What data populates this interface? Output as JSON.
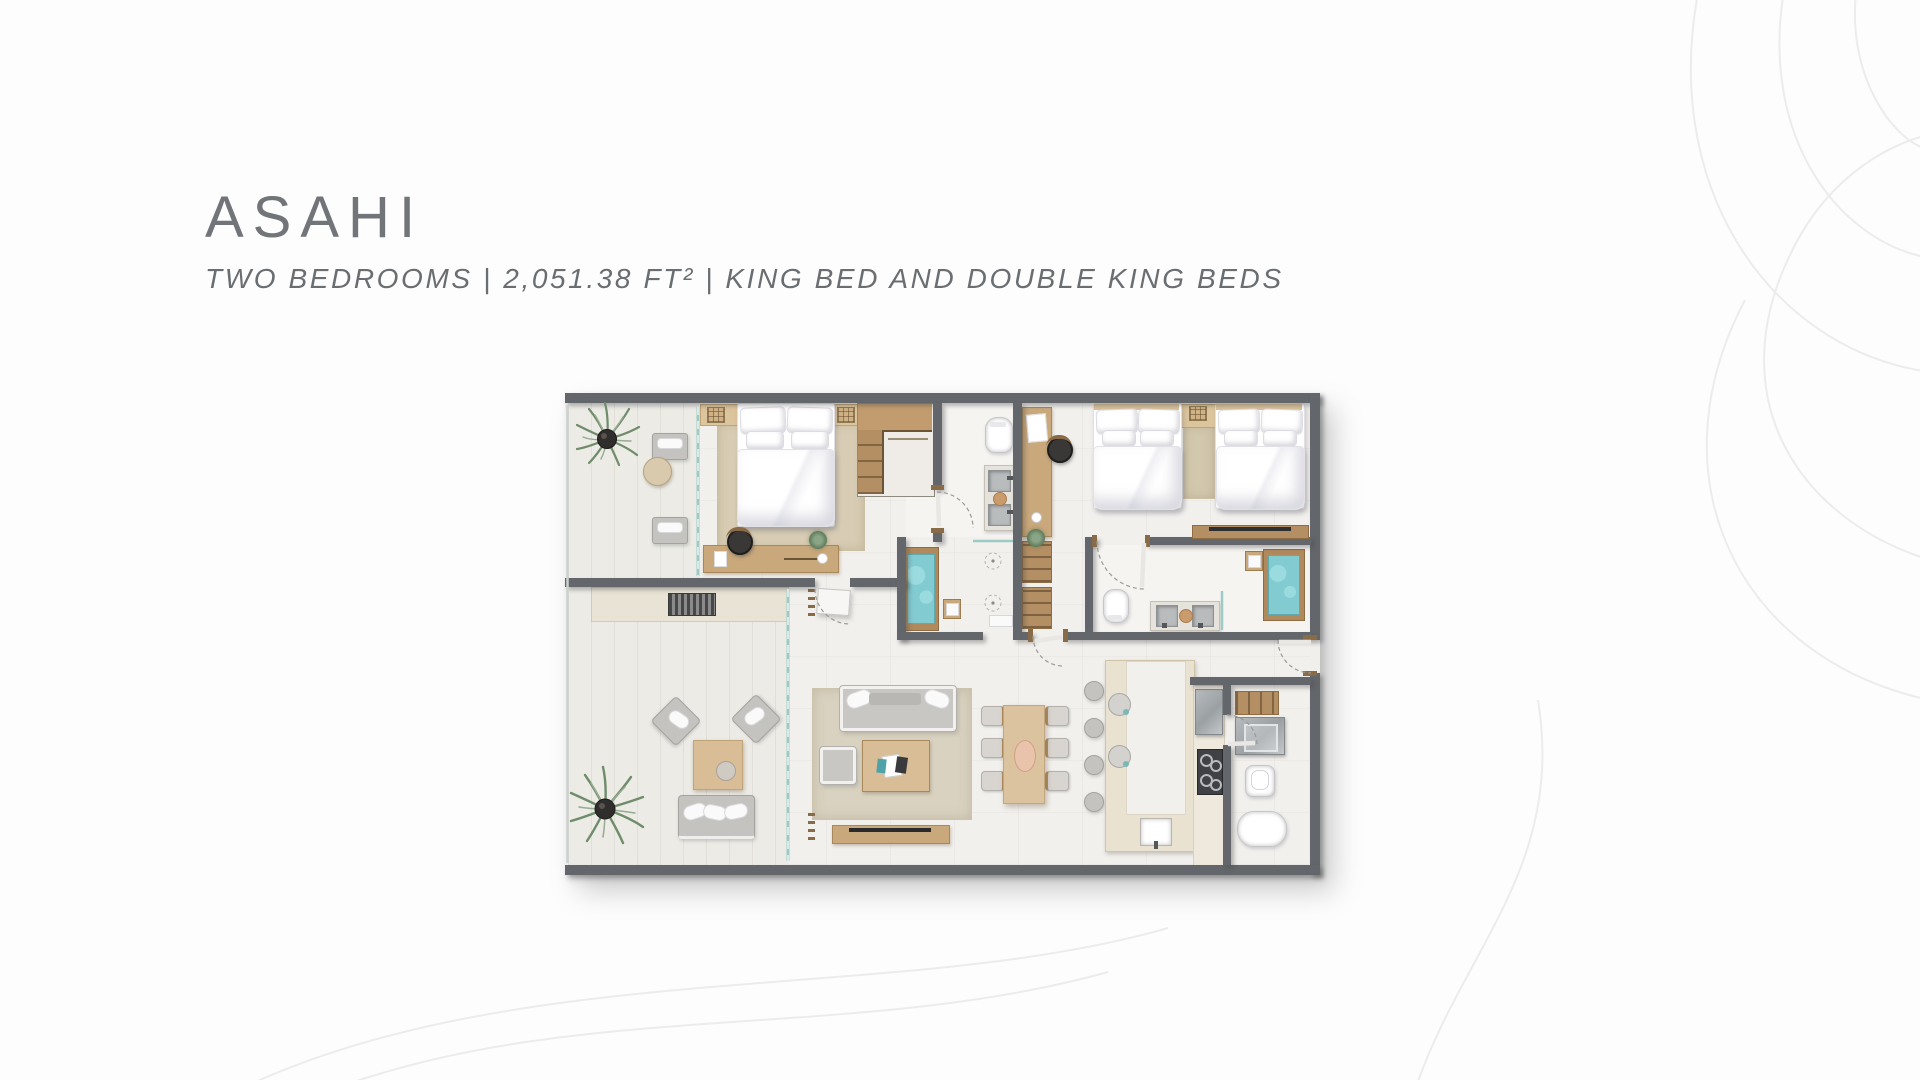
{
  "page": {
    "background": "#fdfdfd"
  },
  "header": {
    "title": "ASAHI",
    "subtitle": "TWO BEDROOMS | 2,051.38 FT² | KING BED AND DOUBLE KING BEDS"
  },
  "floorplan": {
    "view": "top-down architectural rendering, no text labels",
    "rooms": {
      "terrace": [
        "palm-plant",
        "lounge-chair",
        "lounge-chair",
        "round-side-table",
        "outdoor-armchair",
        "outdoor-armchair",
        "outdoor-coffee-table",
        "outdoor-sofa",
        "palm-plant",
        "built-in-bench",
        "ac-vent-grille"
      ],
      "primary_bedroom": [
        "king-bed",
        "nightstand",
        "nightstand",
        "table-lamp",
        "table-lamp",
        "area-rug",
        "built-in-wardrobe",
        "desk",
        "desk-chair",
        "desk-plant",
        "coffee-cup"
      ],
      "primary_bathroom": [
        "toilet",
        "double-sink-vanity",
        "soap-tray",
        "soaking-tub",
        "wood-stool",
        "walk-in-shower",
        "shower-heads",
        "glass-screen"
      ],
      "second_bedroom": [
        "king-bed",
        "king-bed",
        "shared-nightstand",
        "table-lamp",
        "runner-rug",
        "tv-console",
        "vanity-desk",
        "desk-chair",
        "open-wardrobe-shelves",
        "plant"
      ],
      "second_bathroom": [
        "toilet",
        "double-sink-vanity",
        "soap-tray",
        "soaking-tub",
        "wood-stool",
        "glass-screen"
      ],
      "living_room": [
        "sofa",
        "throw-pillows",
        "armchair",
        "coffee-table",
        "magazines",
        "area-rug",
        "tv-console",
        "television",
        "towel-ladder",
        "towel-ladder"
      ],
      "dining_area": [
        "dining-table",
        "dining-chairs-6",
        "serving-tray"
      ],
      "kitchen": [
        "u-shaped-counter",
        "bar-stools-4",
        "decor-plates",
        "kitchen-sink",
        "cooktop-4-burners",
        "refrigerator"
      ],
      "utility_room": [
        "wood-cabinet",
        "washer",
        "toilet",
        "basin"
      ],
      "entry": [
        "entry-door-swing",
        "interior-door-swings",
        "sliding-glass-doors"
      ]
    },
    "colors": {
      "wall": "#63666a",
      "floor": "#f1efec",
      "terrace_floor": "#ecebe5",
      "wood": "#c9a87b",
      "wood_dark": "#b08a5c",
      "rug": "#d8cdb4",
      "tub_water": "#82cbd1",
      "linen": "#ffffff",
      "upholstery": "#c5c3c0",
      "stainless": "#a7abae",
      "plant": "#6f8c6b",
      "glass": "#8fc6c0",
      "title_text": "#717478",
      "contour_lines": "#ececec"
    }
  }
}
